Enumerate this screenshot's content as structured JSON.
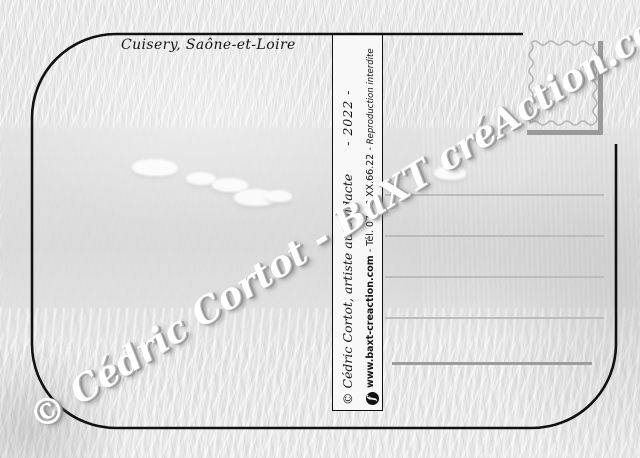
{
  "card": {
    "caption": "Cuisery, Saône-et-Loire",
    "watermark": "© Cédric Cortot - BaXT créAction.com",
    "spine": {
      "credit": "© Cédric Cortot,  artiste autodidacte",
      "year": "- 2022 -",
      "facebook_letter": "f",
      "site": "www.baxt-creaction.com",
      "sep1": "-",
      "phone": "Tél. 07.88.XX.66.22",
      "sep2": "-",
      "notice": "Reproduction interdite"
    }
  },
  "colors": {
    "outline": "#111111",
    "spine_background": "#f8f8f8",
    "address_line": "#bcbcbc",
    "address_line_bold": "#9c9c9c",
    "stamp_outline": "#adadad",
    "corner_bracket": "#9a9a9a",
    "watermark_fill": "#ffffff",
    "background_base": "#e4e4e4"
  }
}
